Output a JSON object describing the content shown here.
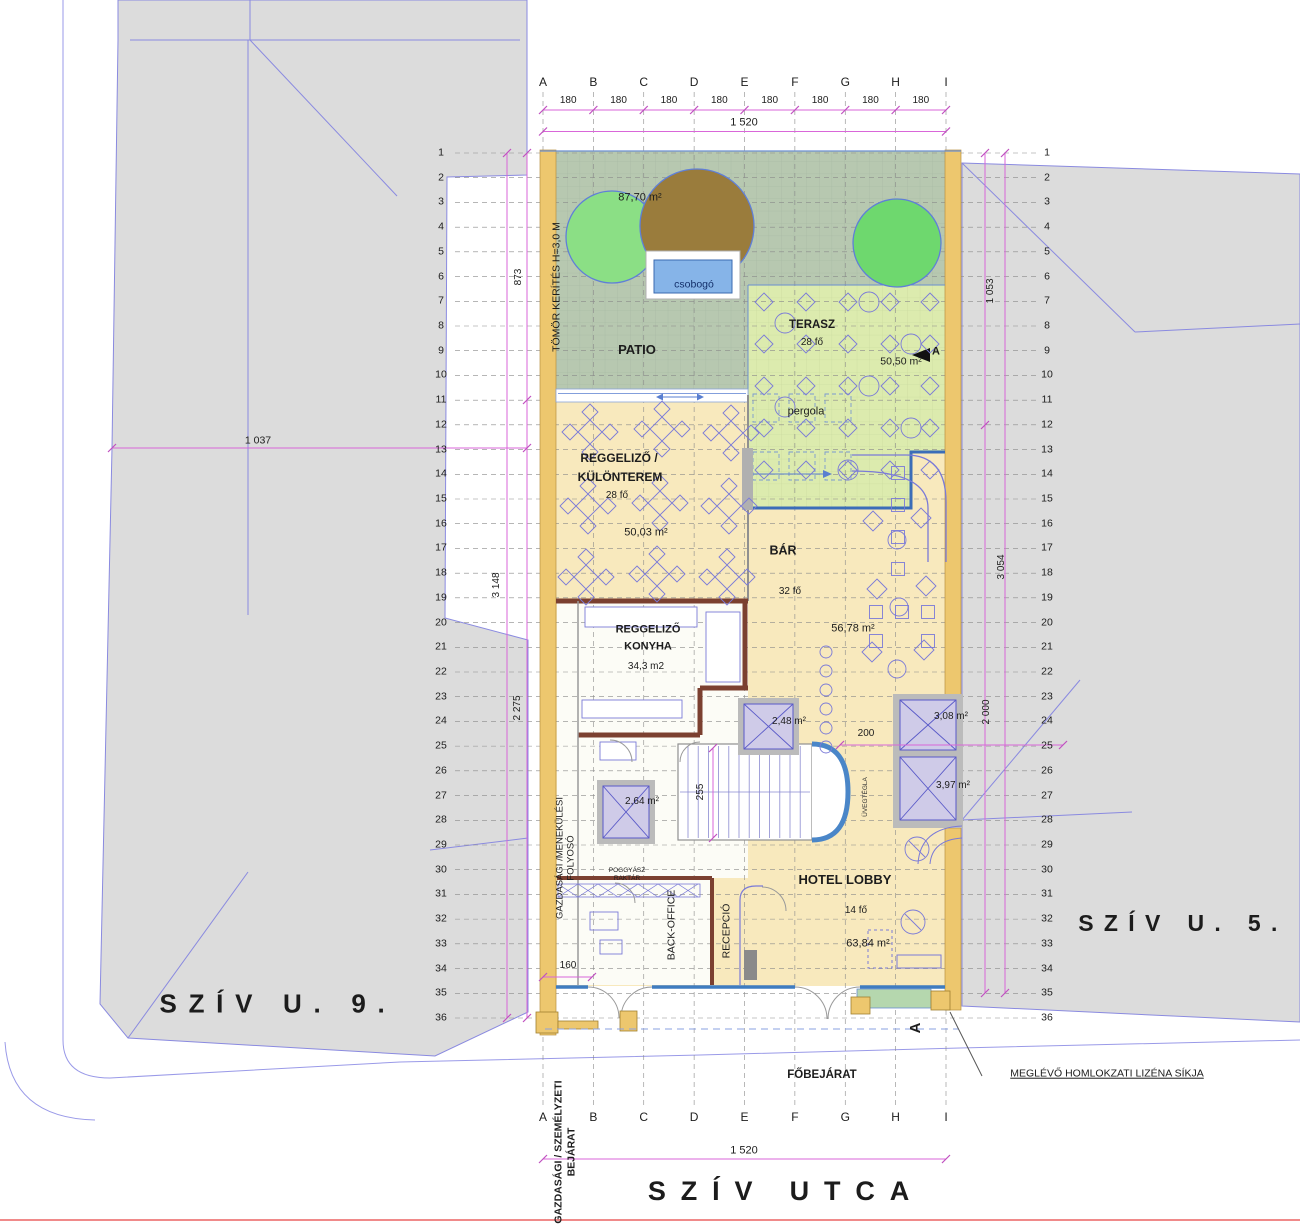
{
  "drawing": {
    "title": "Hotel ground floor site plan",
    "streets": {
      "bottom": "SZÍV UTCA",
      "left_building": "SZÍV U. 9.",
      "right_building": "SZÍV U. 5."
    },
    "grid": {
      "letters": [
        "A",
        "B",
        "C",
        "D",
        "E",
        "F",
        "G",
        "H",
        "I"
      ],
      "bay": "180",
      "total": "1 520",
      "rows": 36
    },
    "rooms": {
      "patio": {
        "name": "PATIO",
        "area": "87,70 m²"
      },
      "terasz": {
        "name": "TERASZ",
        "capacity": "28 fő",
        "area": "50,50 m²"
      },
      "pergola": "pergola",
      "reggelizo": {
        "name1": "REGGELIZŐ /",
        "name2": "KÜLÖNTEREM",
        "capacity": "28 fő",
        "area": "50,03 m²"
      },
      "bar": {
        "name": "BÁR",
        "capacity": "32 fő",
        "area": "56,78 m²"
      },
      "konyha": {
        "name1": "REGGELIZŐ",
        "name2": "KONYHA",
        "area": "34,3 m2"
      },
      "lobby": {
        "name": "HOTEL LOBBY",
        "capacity": "14 fő",
        "area": "63,84 m²"
      },
      "recepcio": "RECEPCIÓ",
      "back_office": "BACK-OFFICE",
      "poggyasz1": "POGGYÁSZ",
      "poggyasz2": "RAKTÁR",
      "folyoso1": "GAZDASÁGI /MENEKÜLÉSI",
      "folyoso2": "FOLYOSÓ",
      "csobogo": "csobogó",
      "uvegtegla": "ÜVEGTÉGLA"
    },
    "elevators": {
      "e1": "2,48 m²",
      "e2": "3,08 m²",
      "e3": "3,97 m²",
      "e4": "2,64 m²"
    },
    "annotations": {
      "kerites": "TÖMÖR KERÍTÉS H=3,0 M",
      "fobejarat": "FŐBEJÁRAT",
      "lizena": "MEGLÉVŐ HOMLOKZATI LIZÉNA SÍKJA",
      "gazd1": "GAZDASÁGI / SZEMÉLYZETI",
      "gazd2": "BEJÁRAT",
      "section": "A"
    },
    "dimensions": {
      "left_total": "3 148",
      "left_upper": "873",
      "left_lower": "2 275",
      "right_total": "3 054",
      "right_upper": "1 053",
      "right_lower": "2 000",
      "block": "1 037",
      "stair": "255",
      "entry": "160",
      "bar": "200"
    },
    "colors": {
      "building_gray": "#dcdcdc",
      "outline_blue": "#8a8ae0",
      "room_cream": "#f8e9bd",
      "wall_ochre": "#edc76e",
      "patio_green": "#b7c8b0",
      "terrace_green": "#dcebae",
      "water_blue": "#86b4e8",
      "furniture_blue": "#7a7ad8",
      "dimension_magenta": "#d966d9",
      "kitchen_wall_brown": "#7b4030",
      "elevator_lavender": "#cfcbe8",
      "facade_blue": "#3f7cc0",
      "tree_green": "#8bdf85",
      "tree_brown": "#9a7c3c",
      "entry_mat_green": "#b5d7ae",
      "street_red": "#f08a8a"
    }
  }
}
